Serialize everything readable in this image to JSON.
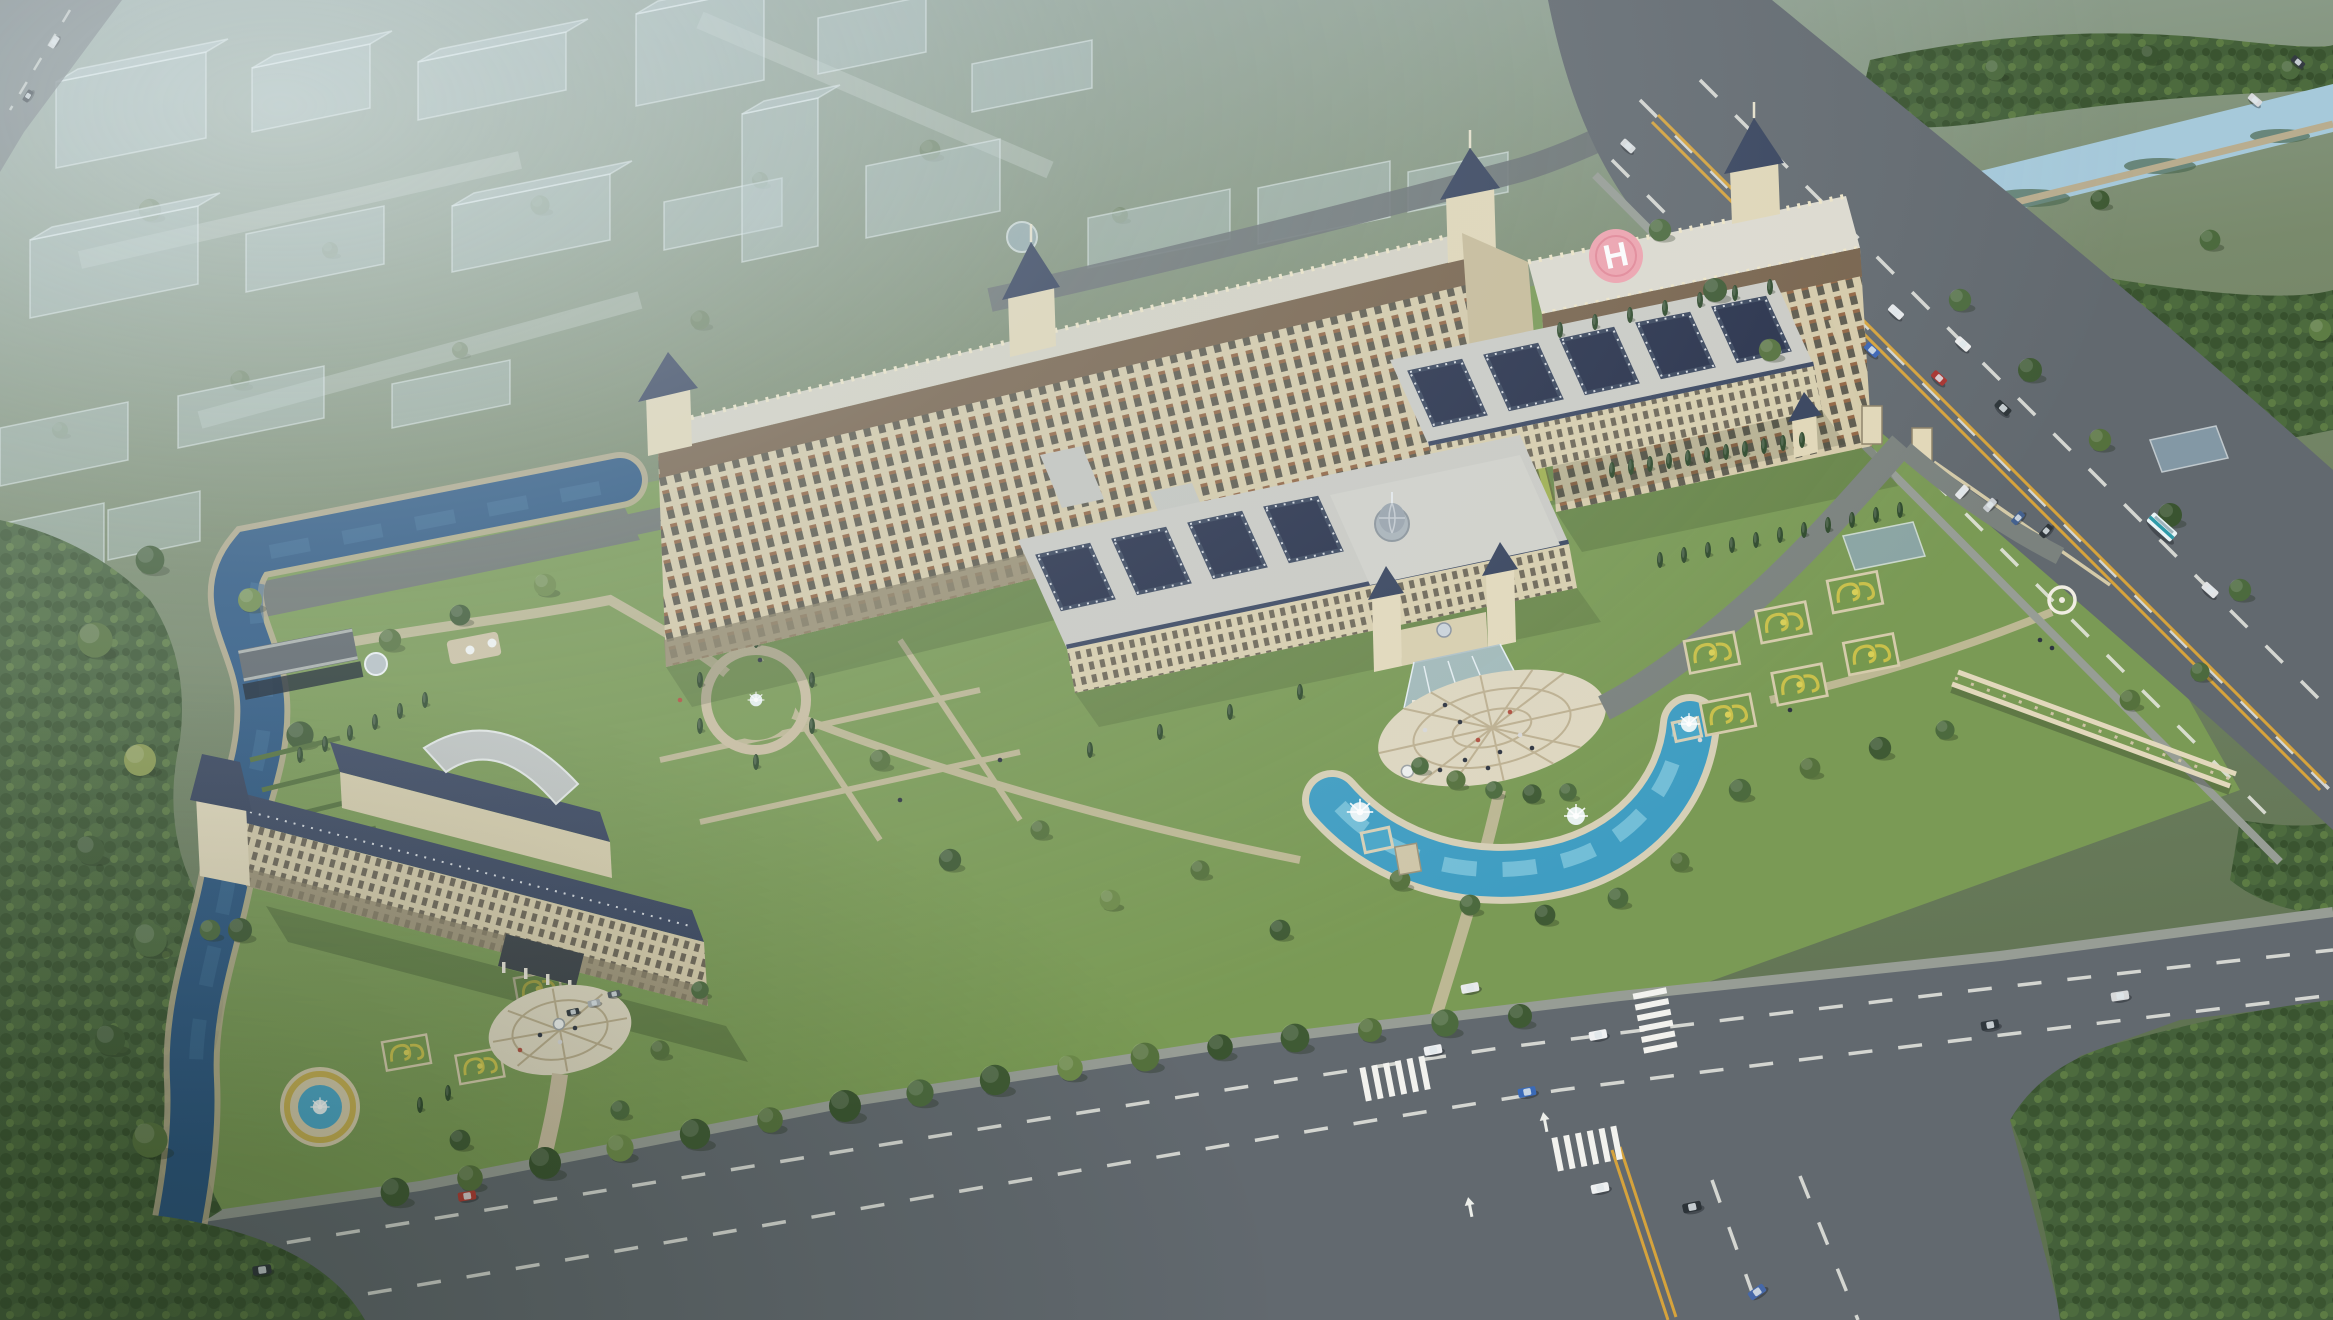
{
  "scene": {
    "description": "Overcast aerial architectural rendering of a grand European-classical hospital/hotel campus: two long beige high-rise slabs with towers and a rooftop helipad, front courtyard wings with dark sunken courtyards and a central dome, an oval entrance plaza with glass porte-cochere and crescent fountain pool, formal parterre gardens, a separate south-west wing with circular forecourt, a winding river and canal, ghosted translucent city massing blocks to the north-west, dense perimeter forest, and arterial roads with an intersection, crosswalks and scattered vehicles.",
    "time_of_day": "overcast dusk",
    "helipad": {
      "letter": "H",
      "pad_color": "#f0a3af"
    },
    "palette": {
      "sky_haze": "#cfdce2",
      "background_green": "#75856b",
      "site_lawn": "#7a9a55",
      "facade_beige": "#d6cbaa",
      "facade_band_bronze": "#77624b",
      "roof_flat": "#d6d3c5",
      "roof_slate": "#3a4660",
      "courtyard_dark": "#27304a",
      "lime_lawn": "#b9ca5c",
      "river_water": "#2a5580",
      "canal_water": "#a6c9da",
      "pool_water": "#3f9dc2",
      "road_asphalt": "#62696f",
      "path_tan": "#c9bda0",
      "plaza_paving": "#ded7c0",
      "tree_dark": "#3f5a34",
      "tree_olive": "#71873f",
      "lane_marking": "#e9e9e3",
      "center_line_yellow": "#d6a33c",
      "ghost_block": "#c2d4da"
    },
    "landmarks": [
      "ghost-city-district",
      "north-east-canal",
      "perimeter-forest",
      "west-river",
      "west-bridge",
      "main-slab-west",
      "main-slab-east",
      "rooftop-helipad",
      "clock-towers",
      "courtyard-wing-rear",
      "courtyard-wing-front",
      "central-dome-pavilion",
      "entrance-glass-canopy",
      "entrance-plaza",
      "crescent-fountain-pool",
      "formal-parterre-gardens",
      "pergola-colonnade",
      "garden-rotunda",
      "southwest-wing",
      "fan-glass-atrium",
      "circular-forecourt",
      "garden-fountain-pool",
      "boundary-wall-and-gates",
      "east-arterial-road",
      "south-arterial-road",
      "road-intersection",
      "zebra-crosswalks",
      "vehicles",
      "pedestrians"
    ],
    "vehicle_colors": [
      "white",
      "silver",
      "dark-gray",
      "red",
      "blue",
      "teal-and-white-bus"
    ]
  }
}
